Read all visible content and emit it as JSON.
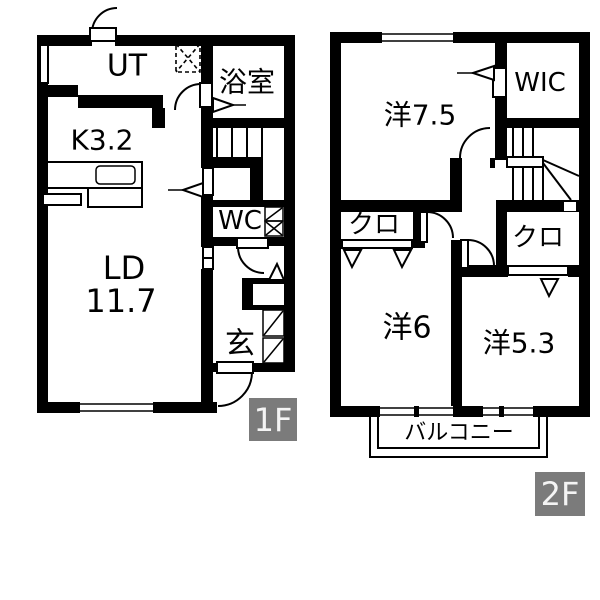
{
  "colors": {
    "wall": "#000000",
    "bg": "#ffffff",
    "label_bg": "#7b7b7b",
    "label_fg": "#f4f4f4"
  },
  "floor1": {
    "label": "1F",
    "rooms": {
      "ut": {
        "label": "UT"
      },
      "bath": {
        "label": "浴室"
      },
      "kitchen": {
        "label": "K3.2"
      },
      "wc": {
        "label": "WC"
      },
      "living": {
        "label": "LD",
        "size": "11.7"
      },
      "entrance": {
        "label": "玄"
      }
    }
  },
  "floor2": {
    "label": "2F",
    "rooms": {
      "west75": {
        "label": "洋7.5"
      },
      "wic": {
        "label": "WIC"
      },
      "closet_left": {
        "label": "クロ"
      },
      "closet_right": {
        "label": "クロ"
      },
      "west6": {
        "label": "洋6"
      },
      "west53": {
        "label": "洋5.3"
      },
      "balcony": {
        "label": "バルコニー"
      }
    }
  }
}
